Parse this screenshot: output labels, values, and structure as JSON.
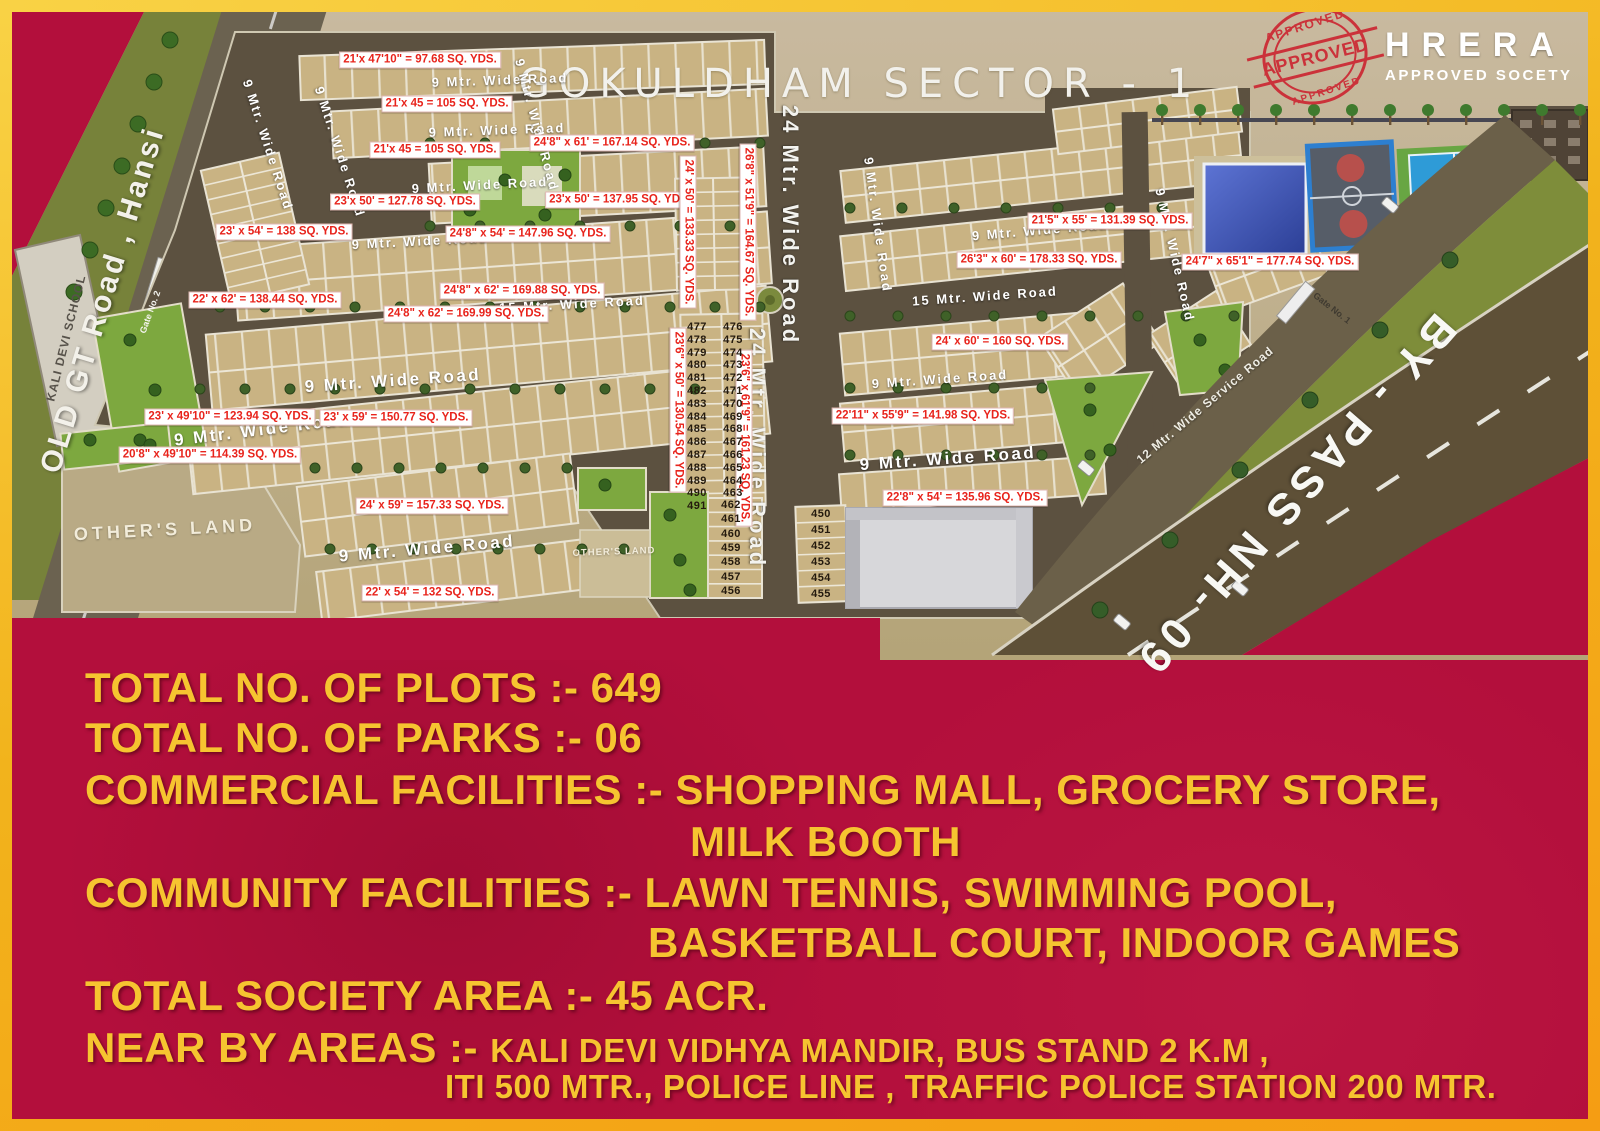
{
  "title": "GOKULDHAM  SECTOR - 1",
  "logo": {
    "stamp_word": "APPROVED",
    "org": "HRERA",
    "tagline": "APPROVED SOCETY"
  },
  "colors": {
    "crimson": "#b30f3c",
    "gold": "#f6c430",
    "map_tan": "#c2b28a",
    "label_red": "#e8241c",
    "road_dark": "#5c5140"
  },
  "map": {
    "road_labels": [
      {
        "t": "9 Mtr. Wide Road",
        "x": 500,
        "y": 80,
        "r": -2,
        "c": ""
      },
      {
        "t": "9 Mtr. Wide Road",
        "x": 497,
        "y": 130,
        "r": -2,
        "c": ""
      },
      {
        "t": "9 Mtr. Wide Road",
        "x": 480,
        "y": 185,
        "r": -3,
        "c": ""
      },
      {
        "t": "9 Mtr. Wide Road",
        "x": 420,
        "y": 241,
        "r": -3,
        "c": ""
      },
      {
        "t": "15 Mtr. Wide Road",
        "x": 572,
        "y": 304,
        "r": -3,
        "c": ""
      },
      {
        "t": "9 Mtr. Wide Road",
        "x": 393,
        "y": 381,
        "r": -4,
        "c": "lg"
      },
      {
        "t": "9 Mtr. Wide Road",
        "x": 262,
        "y": 430,
        "r": -7,
        "c": "lg"
      },
      {
        "t": "9 Mtr. Wide Road",
        "x": 427,
        "y": 549,
        "r": -5,
        "c": "lg"
      },
      {
        "t": "9 Mtr. Wide Road",
        "x": 1040,
        "y": 230,
        "r": -5,
        "c": ""
      },
      {
        "t": "15 Mtr. Wide Road",
        "x": 985,
        "y": 296,
        "r": -4,
        "c": ""
      },
      {
        "t": "9 Mtr. Wide Road",
        "x": 940,
        "y": 379,
        "r": -4,
        "c": ""
      },
      {
        "t": "9 Mtr. Wide Road",
        "x": 948,
        "y": 459,
        "r": -4,
        "c": "lg"
      },
      {
        "t": "9 Mtr. Wide Road",
        "x": 268,
        "y": 145,
        "r": 72,
        "c": ""
      },
      {
        "t": "9 Mtr. Wide Road",
        "x": 340,
        "y": 152,
        "r": 72,
        "c": ""
      },
      {
        "t": "9 Mtr. Wide Road",
        "x": 537,
        "y": 125,
        "r": 75,
        "c": ""
      },
      {
        "t": "9 Mtr. Wide Road",
        "x": 878,
        "y": 225,
        "r": 82,
        "c": ""
      },
      {
        "t": "9 Mtr. Wide Road",
        "x": 1175,
        "y": 255,
        "r": 77,
        "c": ""
      },
      {
        "t": "24 Mtr. Wide Road",
        "x": 790,
        "y": 225,
        "r": 90,
        "c": "v24"
      },
      {
        "t": "24 Mtr. Wide Road",
        "x": 757,
        "y": 448,
        "r": 90,
        "c": "v24"
      }
    ],
    "dim_labels": [
      {
        "t": "21'x 47'10\" = 97.68 SQ. YDS.",
        "x": 420,
        "y": 60,
        "r": 0
      },
      {
        "t": "24'8\" x 61' = 167.14 SQ. YDS.",
        "x": 612,
        "y": 143,
        "r": 0
      },
      {
        "t": "21'x 45 = 105 SQ. YDS.",
        "x": 447,
        "y": 104,
        "r": 0
      },
      {
        "t": "21'x 45 = 105 SQ. YDS.",
        "x": 435,
        "y": 150,
        "r": 0
      },
      {
        "t": "23'x 50' = 127.78 SQ. YDS.",
        "x": 405,
        "y": 202,
        "r": 0
      },
      {
        "t": "23'x 50' = 137.95 SQ. YDS.",
        "x": 620,
        "y": 200,
        "r": 0
      },
      {
        "t": "24'8\" x 54' = 147.96 SQ. YDS.",
        "x": 528,
        "y": 234,
        "r": 0
      },
      {
        "t": "24'8\" x 62' = 169.88 SQ. YDS.",
        "x": 522,
        "y": 291,
        "r": 0
      },
      {
        "t": "23' x 54' = 138 SQ. YDS.",
        "x": 284,
        "y": 232,
        "r": 0
      },
      {
        "t": "22' x 62' = 138.44 SQ. YDS.",
        "x": 265,
        "y": 300,
        "r": 0
      },
      {
        "t": "24'8\" x 62' = 169.99 SQ. YDS.",
        "x": 466,
        "y": 314,
        "r": 0
      },
      {
        "t": "23' x 49'10\" = 123.94 SQ. YDS.",
        "x": 230,
        "y": 417,
        "r": 0
      },
      {
        "t": "23' x 59' = 150.77 SQ. YDS.",
        "x": 396,
        "y": 418,
        "r": 0
      },
      {
        "t": "20'8\" x 49'10\" = 114.39 SQ. YDS.",
        "x": 210,
        "y": 455,
        "r": 0
      },
      {
        "t": "24' x 59' = 157.33 SQ. YDS.",
        "x": 432,
        "y": 506,
        "r": 0
      },
      {
        "t": "22' x 54' = 132 SQ. YDS.",
        "x": 430,
        "y": 593,
        "r": 0
      },
      {
        "t": "22'8\" x 54' = 135.96 SQ. YDS.",
        "x": 965,
        "y": 498,
        "r": 0
      },
      {
        "t": "22'11\" x 55'9\" = 141.98 SQ. YDS.",
        "x": 923,
        "y": 416,
        "r": 0
      },
      {
        "t": "24' x 60' = 160 SQ. YDS.",
        "x": 1000,
        "y": 342,
        "r": 0
      },
      {
        "t": "21'5\" x 55' = 131.39 SQ. YDS.",
        "x": 1110,
        "y": 221,
        "r": 0
      },
      {
        "t": "26'3\" x 60' = 178.33 SQ. YDS.",
        "x": 1039,
        "y": 260,
        "r": 0
      },
      {
        "t": "24'7\" x 65'1\" = 177.74 SQ. YDS.",
        "x": 1270,
        "y": 262,
        "r": 0
      },
      {
        "t": "23'6\" x 50' = 130.54 SQ. YDS.",
        "x": 678,
        "y": 410,
        "r": 90
      },
      {
        "t": "23'6\" x 61'9\" = 161.23 SQ. YDS.",
        "x": 744,
        "y": 438,
        "r": 90
      },
      {
        "t": "24' x 50' = 133.33 SQ. YDS.",
        "x": 688,
        "y": 232,
        "r": 90
      },
      {
        "t": "26'8\" x 51'9\" = 164.67 SQ. YDS.",
        "x": 748,
        "y": 232,
        "r": 90
      }
    ],
    "area_texts": [
      {
        "t": "OLD GT Road , Hansi",
        "x": 103,
        "y": 300,
        "r": -73,
        "c": "t-oldgt"
      },
      {
        "t": "KALI DEVI SCHOOL",
        "x": 66,
        "y": 338,
        "r": -76,
        "c": "t-school"
      },
      {
        "t": "Gate No. 2",
        "x": 150,
        "y": 312,
        "r": -70,
        "c": "t-gate"
      },
      {
        "t": "Gate No. 1",
        "x": 1332,
        "y": 308,
        "r": 38,
        "c": "t-gate dark"
      },
      {
        "t": "OTHER'S LAND",
        "x": 165,
        "y": 530,
        "r": -3,
        "c": "t-others"
      },
      {
        "t": "OTHER'S LAND",
        "x": 614,
        "y": 552,
        "r": -2,
        "c": "t-others sm"
      },
      {
        "t": "12 Mtr. Wide Service Road",
        "x": 1205,
        "y": 405,
        "r": -40,
        "c": "t-svc"
      },
      {
        "t": "BY - PASS NH- 09",
        "x": 1295,
        "y": 495,
        "r": 131,
        "c": "t-bypass"
      }
    ],
    "plot_number_groups": [
      {
        "x": 697,
        "y0": 327,
        "dy": 12.8,
        "values": [
          477,
          478,
          479,
          480,
          481,
          482,
          483,
          484,
          485,
          486,
          487,
          488,
          489,
          490,
          491
        ]
      },
      {
        "x": 733,
        "y0": 327,
        "dy": 12.8,
        "values": [
          476,
          475,
          474,
          473,
          472,
          471,
          470,
          469,
          468,
          467,
          466,
          465,
          464,
          463
        ]
      },
      {
        "x": 731,
        "y0": 505,
        "dy": 14.3,
        "values": [
          462,
          461,
          460,
          459,
          458,
          457,
          456
        ]
      },
      {
        "x": 821,
        "y0": 514,
        "dy": 16,
        "values": [
          450,
          451,
          452,
          453,
          454,
          455
        ]
      }
    ]
  },
  "footer": {
    "lines": [
      {
        "x": 85,
        "y": 664,
        "parts": [
          {
            "t": "TOTAL NO. OF PLOTS :- 649",
            "s": 42
          }
        ]
      },
      {
        "x": 85,
        "y": 714,
        "parts": [
          {
            "t": "TOTAL NO. OF PARKS :- 06",
            "s": 42
          }
        ]
      },
      {
        "x": 85,
        "y": 766,
        "parts": [
          {
            "t": "COMMERCIAL FACILITIES :- SHOPPING MALL, GROCERY STORE,",
            "s": 42
          }
        ]
      },
      {
        "x": 690,
        "y": 818,
        "parts": [
          {
            "t": "MILK BOOTH",
            "s": 42
          }
        ]
      },
      {
        "x": 85,
        "y": 869,
        "parts": [
          {
            "t": "COMMUNITY FACILITIES :- LAWN TENNIS, SWIMMING POOL,",
            "s": 42
          }
        ]
      },
      {
        "x": 648,
        "y": 919,
        "parts": [
          {
            "t": "BASKETBALL COURT, INDOOR GAMES",
            "s": 42
          }
        ]
      },
      {
        "x": 85,
        "y": 972,
        "parts": [
          {
            "t": "TOTAL SOCIETY AREA :- 45 ACR.",
            "s": 42
          }
        ]
      },
      {
        "x": 85,
        "y": 1024,
        "parts": [
          {
            "t": "NEAR BY AREAS :- ",
            "s": 42
          },
          {
            "t": "KALI DEVI VIDHYA MANDIR, BUS STAND 2 K.M ,",
            "s": 33
          }
        ]
      },
      {
        "x": 445,
        "y": 1068,
        "parts": [
          {
            "t": "ITI 500 MTR., POLICE LINE , TRAFFIC POLICE STATION 200 MTR.",
            "s": 33
          }
        ]
      }
    ]
  }
}
